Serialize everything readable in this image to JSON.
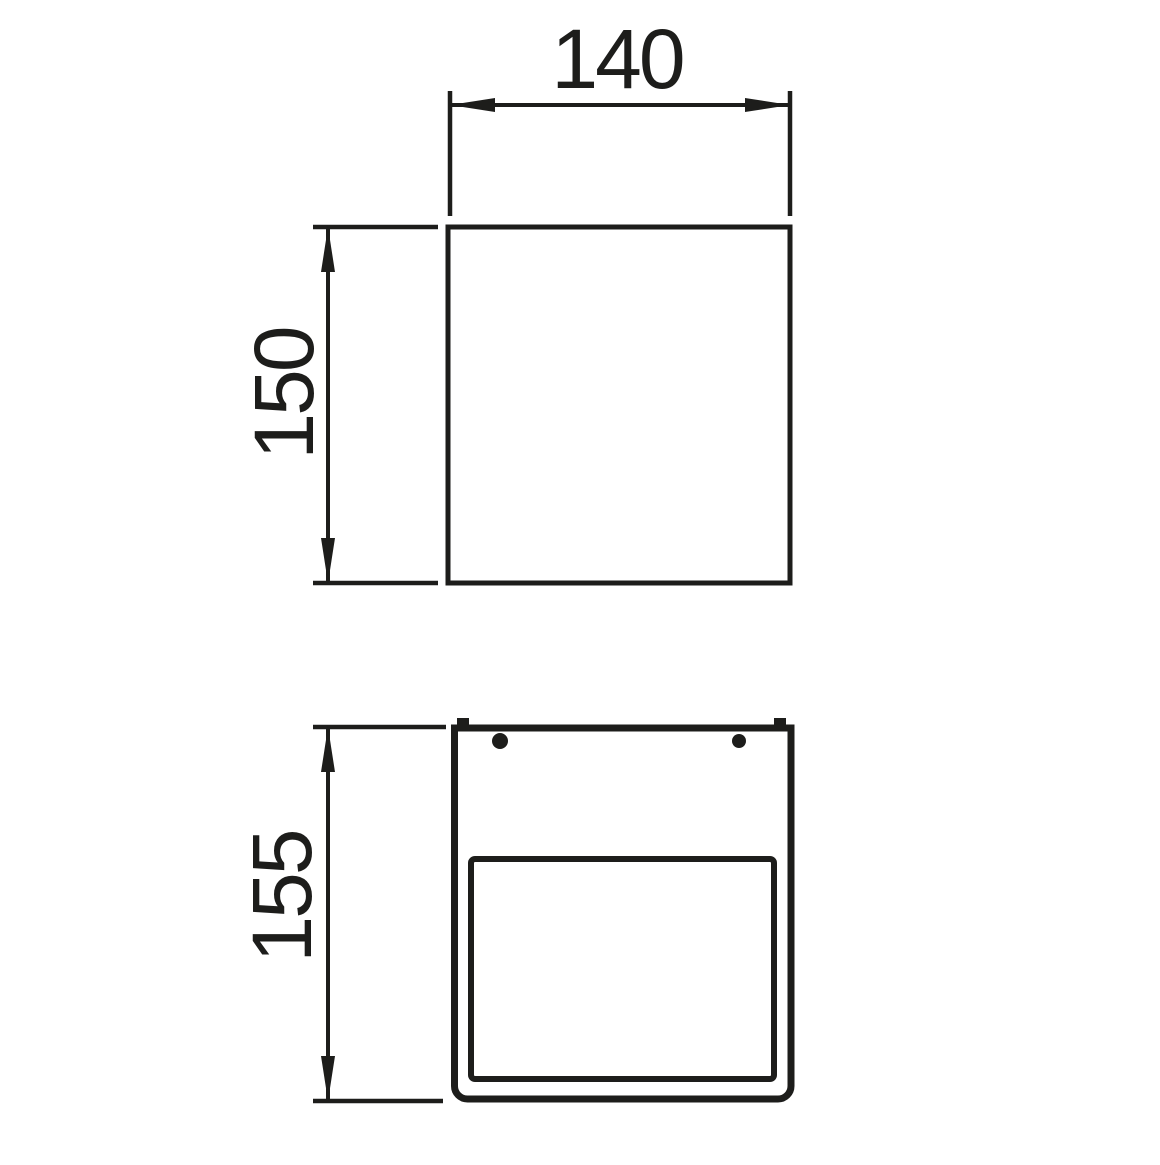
{
  "drawing": {
    "background_color": "#ffffff",
    "line_color": "#1d1d1b",
    "front_view": {
      "width_label": "140",
      "height_label": "150"
    },
    "side_view": {
      "height_label": "155"
    }
  }
}
